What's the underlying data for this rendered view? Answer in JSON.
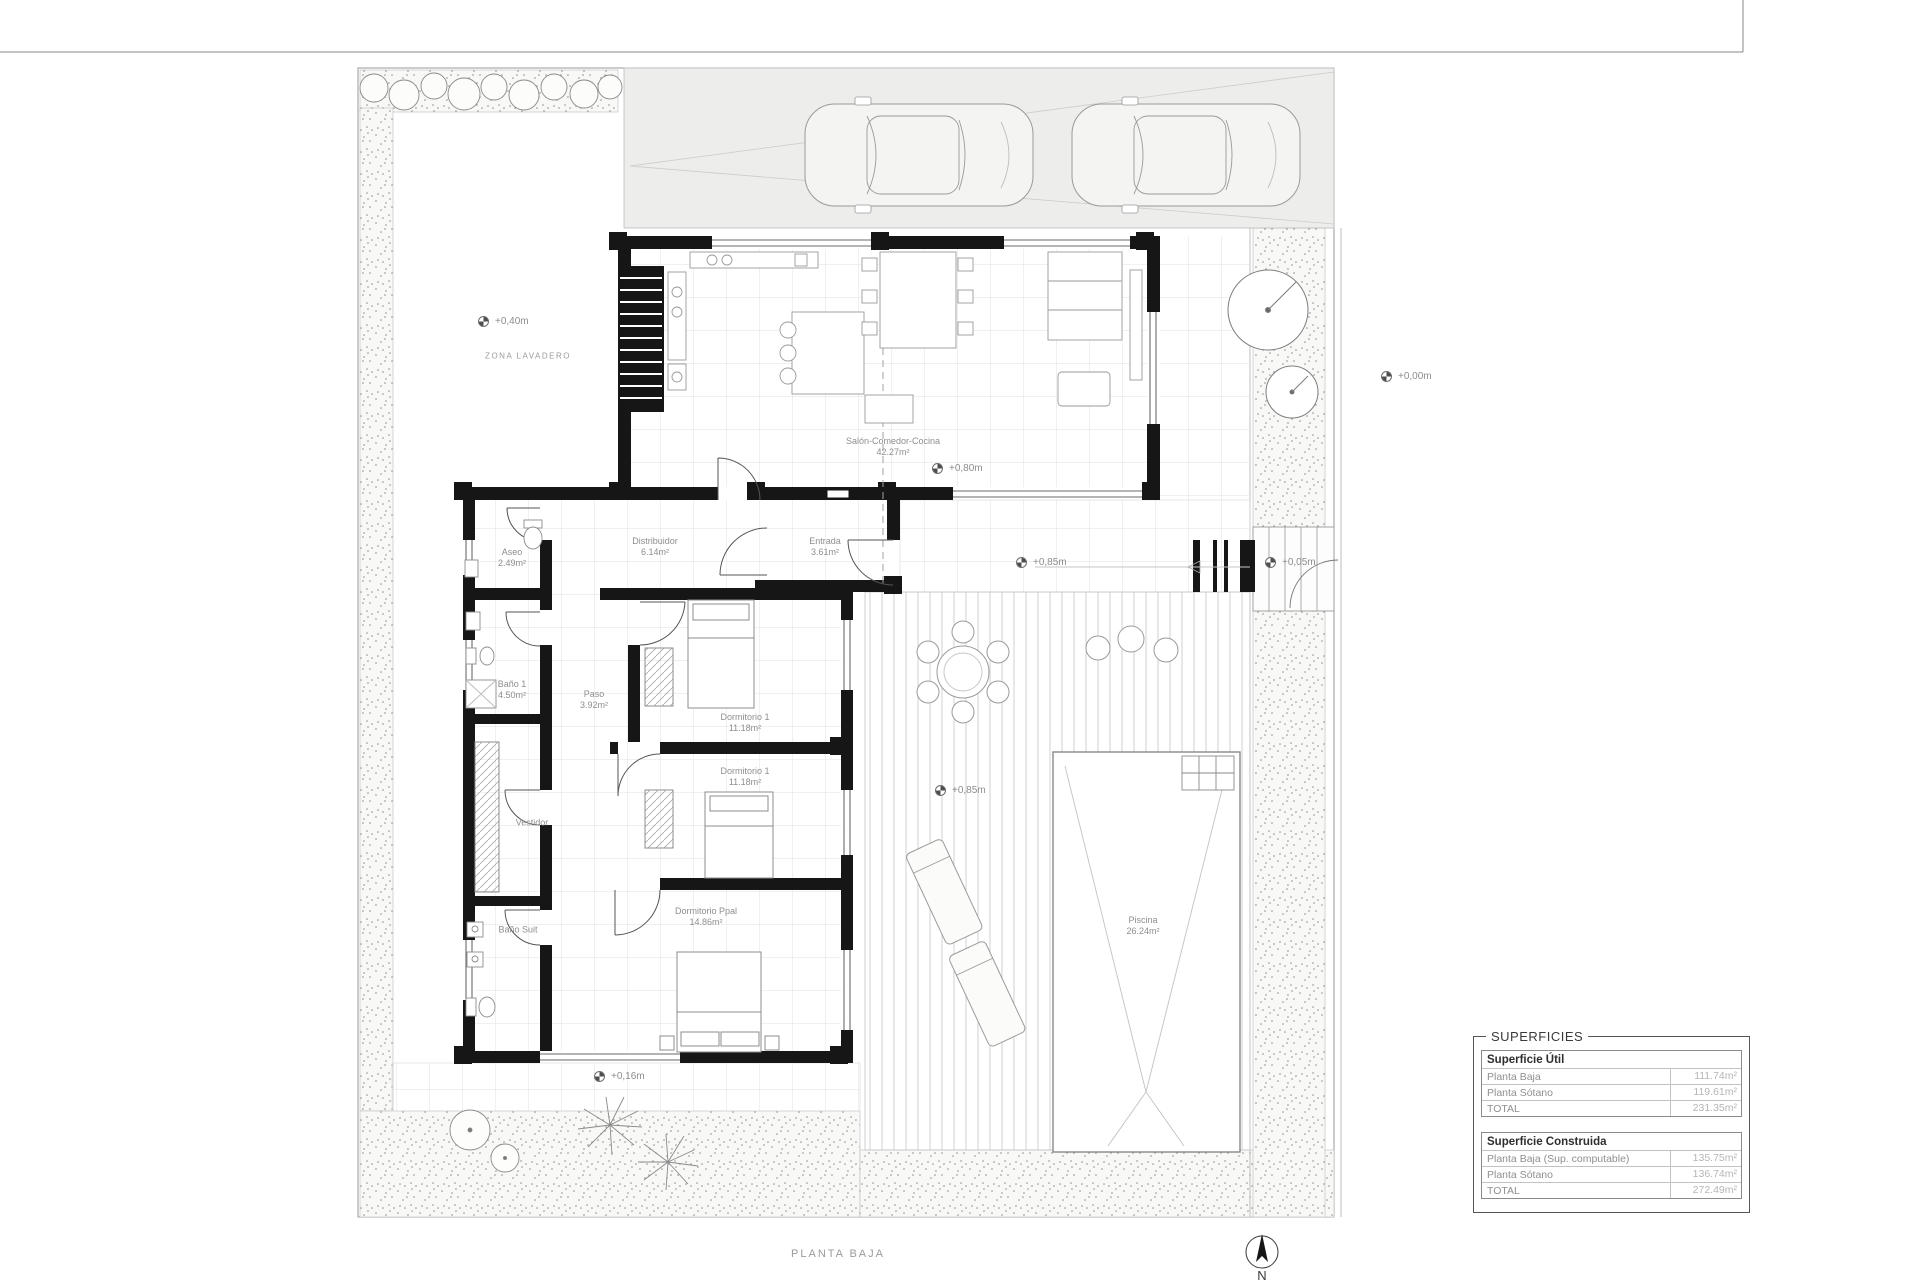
{
  "plan": {
    "title": "PLANTA BAJA",
    "north_label": "N",
    "site_label": "ZONA LAVADERO"
  },
  "rooms": [
    {
      "name": "Salón-Comedor-Cocina",
      "area": "42.27m²"
    },
    {
      "name": "Distribuidor",
      "area": "6.14m²"
    },
    {
      "name": "Entrada",
      "area": "3.61m²"
    },
    {
      "name": "Aseo",
      "area": "2.49m²"
    },
    {
      "name": "Baño 1",
      "area": "4.50m²"
    },
    {
      "name": "Paso",
      "area": "3.92m²"
    },
    {
      "name": "Dormitorio 1",
      "area": "11.18m²"
    },
    {
      "name": "Dormitorio 1",
      "area": "11.18m²"
    },
    {
      "name": "Vestidor",
      "area": ""
    },
    {
      "name": "Baño Suit",
      "area": ""
    },
    {
      "name": "Dormitorio Ppal",
      "area": "14.86m²"
    },
    {
      "name": "Piscina",
      "area": "26.24m²"
    }
  ],
  "levels": [
    {
      "label": "+0,40m"
    },
    {
      "label": "+0,00m"
    },
    {
      "label": "+0,80m"
    },
    {
      "label": "+0,85m"
    },
    {
      "label": "+0,05m"
    },
    {
      "label": "+0,85m"
    },
    {
      "label": "+0,16m"
    }
  ],
  "table": {
    "title": "SUPERFICIES",
    "sections": [
      {
        "header": "Superficie Útil",
        "rows": [
          [
            "Planta Baja",
            "111.74m²"
          ],
          [
            "Planta Sótano",
            "119.61m²"
          ],
          [
            "TOTAL",
            "231.35m²"
          ]
        ]
      },
      {
        "header": "Superficie Construida",
        "rows": [
          [
            "Planta Baja (Sup. computable)",
            "135.75m²"
          ],
          [
            "Planta Sótano",
            "136.74m²"
          ],
          [
            "TOTAL",
            "272.49m²"
          ]
        ]
      }
    ]
  },
  "colors": {
    "wall": "#161616",
    "furniture_line": "#9a9a9a",
    "label_text": "#8e8e8e",
    "value_text": "#b5b5b5"
  }
}
